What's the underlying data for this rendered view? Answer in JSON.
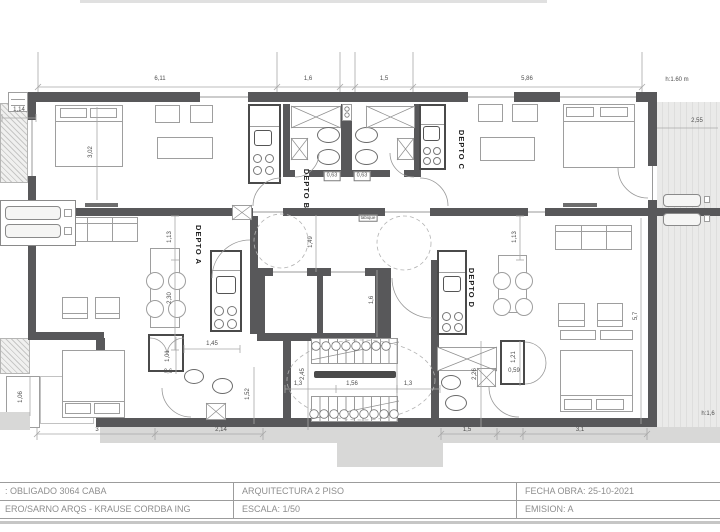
{
  "colors": {
    "wall": "#58585a",
    "terrace_fill": "#e9e9e8",
    "sidewalk_fill": "#d8d8d7",
    "line": "#9e9e9e",
    "text": "#4e4e4e"
  },
  "plan": {
    "unit_labels": [
      {
        "name": "unit-label-depto-a",
        "text": "DEPTO A",
        "x": 198,
        "y": 245
      },
      {
        "name": "unit-label-depto-b",
        "text": "DEPTO B",
        "x": 306,
        "y": 189
      },
      {
        "name": "unit-label-depto-c",
        "text": "DEPTO C",
        "x": 461,
        "y": 150
      },
      {
        "name": "unit-label-depto-d",
        "text": "DEPTO D",
        "x": 471,
        "y": 288
      }
    ],
    "dim_labels": [
      {
        "text": "6,11",
        "x": 160,
        "y": 79
      },
      {
        "text": "1,6",
        "x": 308,
        "y": 79
      },
      {
        "text": "1,5",
        "x": 384,
        "y": 79
      },
      {
        "text": "5,86",
        "x": 527,
        "y": 79
      },
      {
        "text": "1,14",
        "x": 19,
        "y": 110
      },
      {
        "text": "2,55",
        "x": 697,
        "y": 121
      },
      {
        "text": "3,02",
        "x": 91,
        "y": 152,
        "vertical": true
      },
      {
        "text": "1,13",
        "x": 170,
        "y": 237,
        "vertical": true
      },
      {
        "text": "2,30",
        "x": 170,
        "y": 298,
        "vertical": true
      },
      {
        "text": "1,49",
        "x": 311,
        "y": 242,
        "vertical": true
      },
      {
        "text": "1,6",
        "x": 372,
        "y": 300,
        "vertical": true
      },
      {
        "text": "1,13",
        "x": 515,
        "y": 237,
        "vertical": true
      },
      {
        "text": "0,63",
        "x": 332,
        "y": 176,
        "boxed": true
      },
      {
        "text": "0,63",
        "x": 362,
        "y": 176,
        "boxed": true
      },
      {
        "text": "2,45",
        "x": 303,
        "y": 374,
        "vertical": true
      },
      {
        "text": "1,3",
        "x": 298,
        "y": 384
      },
      {
        "text": "1,56",
        "x": 352,
        "y": 384
      },
      {
        "text": "1,3",
        "x": 408,
        "y": 384
      },
      {
        "text": "5,7",
        "x": 636,
        "y": 316,
        "vertical": true
      },
      {
        "text": "1,45",
        "x": 212,
        "y": 344
      },
      {
        "text": "1,01",
        "x": 168,
        "y": 356,
        "vertical": true
      },
      {
        "text": "0,6",
        "x": 168,
        "y": 372
      },
      {
        "text": "1,52",
        "x": 248,
        "y": 394,
        "vertical": true
      },
      {
        "text": "1,21",
        "x": 514,
        "y": 357,
        "vertical": true
      },
      {
        "text": "0,59",
        "x": 514,
        "y": 371
      },
      {
        "text": "2,26",
        "x": 475,
        "y": 374,
        "vertical": true
      },
      {
        "text": "1,06",
        "x": 21,
        "y": 397,
        "vertical": true
      },
      {
        "text": "3",
        "x": 97,
        "y": 430
      },
      {
        "text": "2,14",
        "x": 221,
        "y": 430
      },
      {
        "text": "1,5",
        "x": 467,
        "y": 430
      },
      {
        "text": "3,1",
        "x": 580,
        "y": 430
      }
    ],
    "note_labels": [
      {
        "text": "h:1.60  m",
        "x": 677,
        "y": 80
      },
      {
        "text": "h:1,6",
        "x": 708,
        "y": 414
      },
      {
        "text": "tabique",
        "x": 368,
        "y": 218,
        "boxed": true,
        "tiny": true
      }
    ]
  },
  "title_block": {
    "rows": [
      [
        ": OBLIGADO 3064 CABA",
        "ARQUITECTURA  2 PISO",
        "FECHA OBRA: 25-10-2021"
      ],
      [
        "ERO/SARNO ARQS - KRAUSE CORDBA ING",
        "ESCALA: 1/50",
        "EMISION: A"
      ]
    ]
  }
}
